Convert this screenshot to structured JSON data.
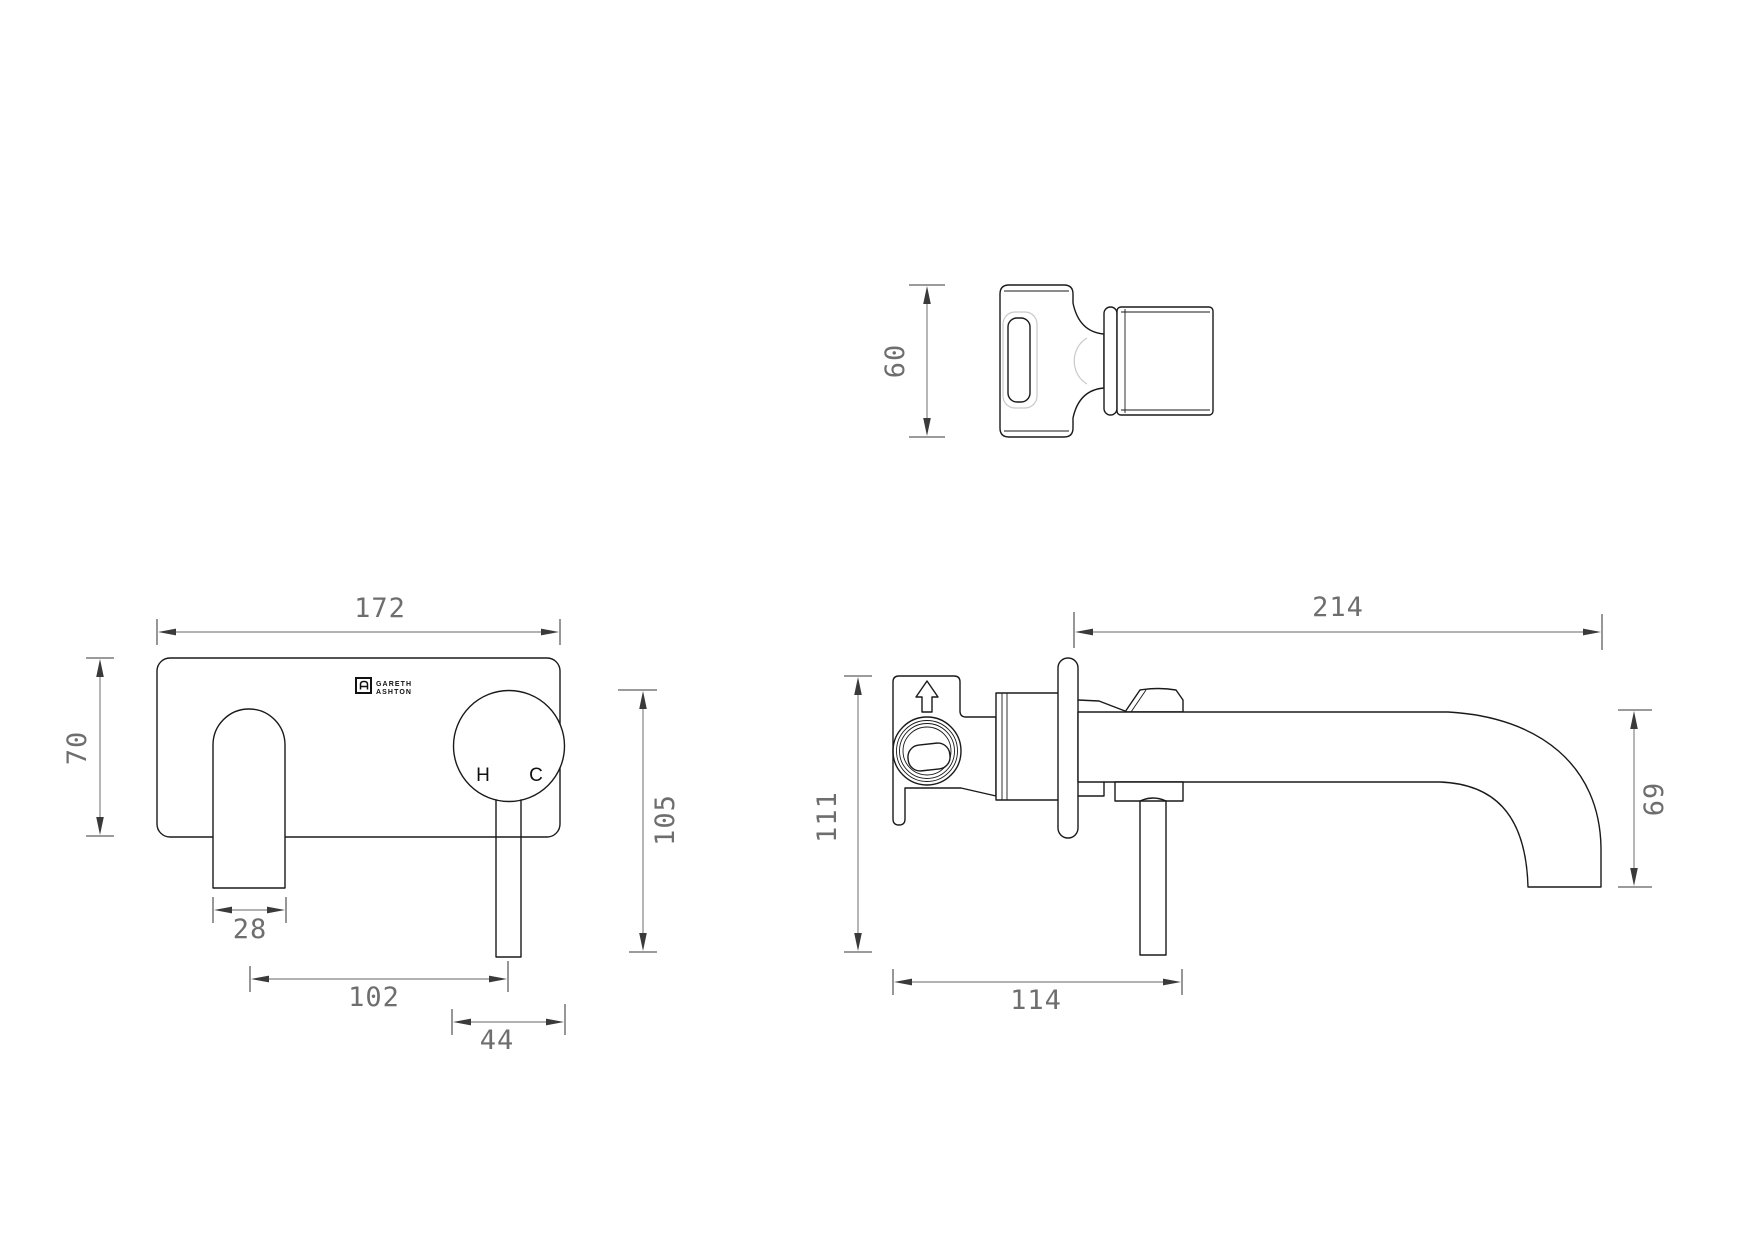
{
  "brand": {
    "line1": "GARETH",
    "line2": "ASHTON"
  },
  "front_view": {
    "hot_label": "H",
    "cold_label": "C",
    "dims": {
      "plate_width": "172",
      "plate_height": "70",
      "spout_width": "28",
      "spout_to_handle": "102",
      "handle_diameter": "44",
      "handle_height": "105"
    }
  },
  "side_view": {
    "dims": {
      "reach": "214",
      "body_height": "111",
      "spout_drop": "69",
      "depth": "114"
    }
  },
  "top_view": {
    "dims": {
      "depth": "60"
    }
  },
  "colors": {
    "outline": "#1a1a1a",
    "dimension_line": "#858585",
    "dimension_text": "#6e6e6e",
    "tangent_line": "#c9c9c9",
    "background": "#ffffff"
  }
}
